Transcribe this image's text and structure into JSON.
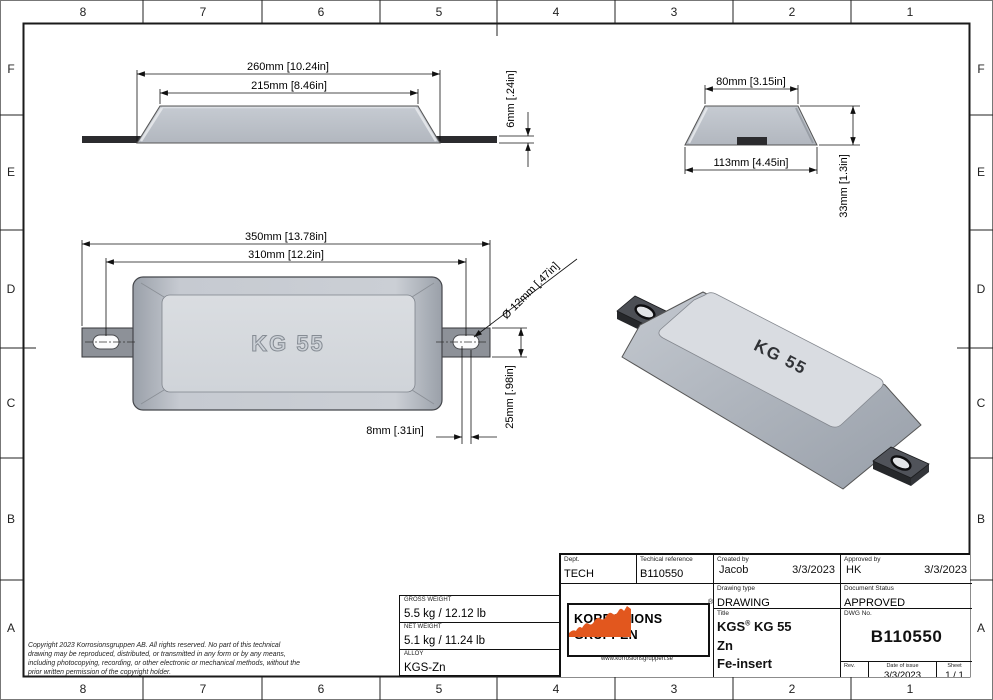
{
  "zones": {
    "cols": [
      "8",
      "7",
      "6",
      "5",
      "4",
      "3",
      "2",
      "1"
    ],
    "rows": [
      "F",
      "E",
      "D",
      "C",
      "B",
      "A"
    ]
  },
  "views": {
    "side": {
      "dim_overall": "260mm [10.24in]",
      "dim_top": "215mm [8.46in]",
      "dim_thickness": "6mm [.24in]"
    },
    "end": {
      "dim_top": "80mm [3.15in]",
      "dim_bottom": "113mm [4.45in]",
      "dim_height": "33mm [1.3in]"
    },
    "plan": {
      "dim_overall": "350mm [13.78in]",
      "dim_holes": "310mm [12.2in]",
      "dim_hole_dia": "Ø 12mm [.47in]",
      "dim_strap_width": "25mm [.98in]",
      "dim_slot": "8mm [.31in]",
      "label": "KG 55"
    },
    "iso": {
      "label": "KG 55"
    }
  },
  "weights": {
    "gross_label": "GROSS WEIGHT",
    "gross": "5.5 kg / 12.12 lb",
    "net_label": "NET WEIGHT",
    "net": "5.1 kg / 11.24 lb",
    "alloy_label": "ALLOY",
    "alloy": "KGS-Zn"
  },
  "copyright": "Copyright 2023 Korrosionsgruppen AB. All rights reserved. No part of this technical drawing may be reproduced, distributed, or transmitted in any form or by any means, including photocopying, recording, or other electronic or mechanical methods, without the prior written permission of the copyright holder.",
  "title_block": {
    "dept_label": "Dept.",
    "dept": "TECH",
    "techref_label": "Techical reference",
    "techref": "B110550",
    "created_label": "Created by",
    "created_name": "Jacob",
    "created_date": "3/3/2023",
    "approved_label": "Approved by",
    "approved_name": "HK",
    "approved_date": "3/3/2023",
    "drawing_type_label": "Drawing type",
    "drawing_type": "DRAWING",
    "doc_status_label": "Document Status",
    "doc_status": "APPROVED",
    "title_label": "Title",
    "title_line1": "KGS",
    "title_mark": "®",
    "title_line1b": " KG 55",
    "title_line2": "Zn",
    "title_line3": "Fe-insert",
    "dwg_label": "DWG No.",
    "dwg_no": "B110550",
    "rev_label": "Rev.",
    "rev": "",
    "date_label": "Date of issue",
    "date_of_issue": "3/3/2023",
    "sheet_label": "Sheet",
    "sheet": "1 / 1"
  },
  "logo": {
    "line1": "KORROSIONS",
    "line2": "GRUPPEN",
    "url": "www.korrosionsgruppen.se",
    "mark": "®"
  },
  "colors": {
    "accent_orange": "#E2571E",
    "body_gray": "#c6cbd2",
    "insert_dark": "#2b2b2e"
  }
}
